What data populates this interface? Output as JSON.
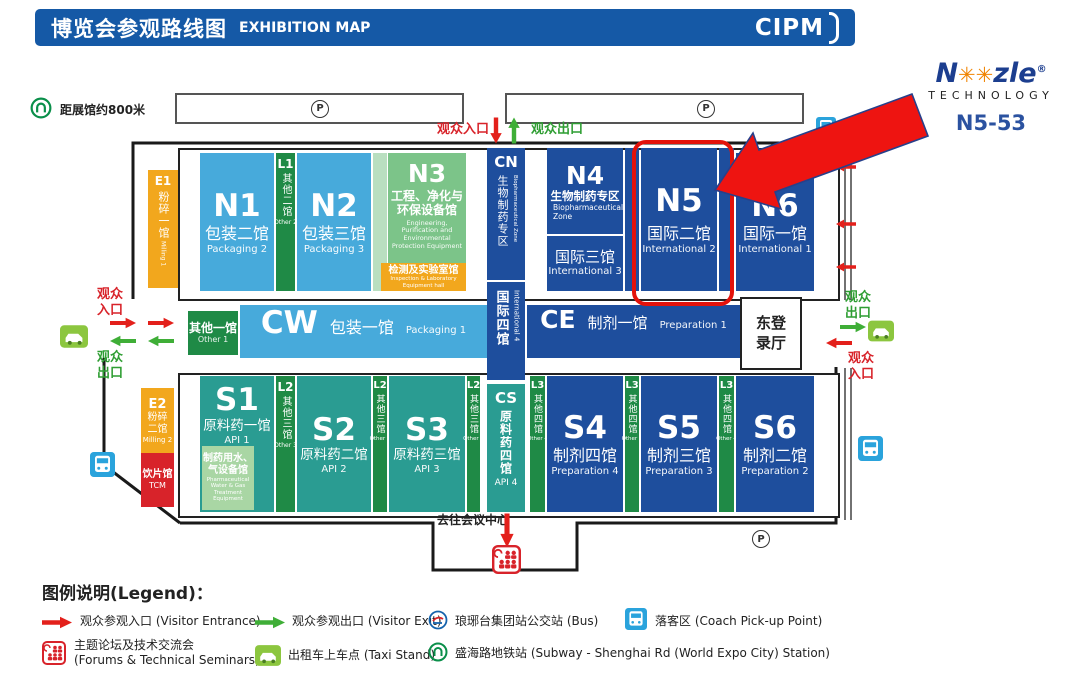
{
  "palette": {
    "header_blue": "#1559a6",
    "dark_blue": "#1e4e9d",
    "light_blue": "#47aadb",
    "teal": "#2a9c92",
    "dark_green": "#1f8a46",
    "hall_green": "#7cc489",
    "orange": "#f2a71d",
    "tcm_red": "#d8232a",
    "arrow_red": "#e3201b",
    "arrow_green": "#3fae37",
    "highlight_red": "#e3120b"
  },
  "header": {
    "title_cn": "博览会参观路线图",
    "title_en": "EXHIBITION MAP",
    "logo_text": "CIPM"
  },
  "branding": {
    "wordmark_n": "N",
    "wordmark_o": "✳",
    "wordmark_rest": "zle",
    "registered": "®",
    "subtitle": "TECHNOLOGY",
    "booth_no": "N5-53"
  },
  "map": {
    "subway_note": "距展馆约800米",
    "parking_label": "P",
    "top_entrance": "观众入口",
    "top_exit": "观众出口",
    "side": {
      "visitors": "观众",
      "entrance": "入口",
      "exit": "出口"
    },
    "east_hall_l1": "东登",
    "east_hall_l2": "录厅",
    "to_conference": "去往会议中心"
  },
  "halls": {
    "E1": {
      "code": "E1",
      "cn": "粉碎一馆",
      "en": "Milling 1"
    },
    "N1": {
      "code": "N1",
      "cn": "包装二馆",
      "en": "Packaging 2"
    },
    "L1": {
      "code": "L1",
      "cn": "其他二馆",
      "en": "Other 2"
    },
    "N2": {
      "code": "N2",
      "cn": "包装三馆",
      "en": "Packaging 3"
    },
    "N3": {
      "code": "N3",
      "cn": "工程、净化与环保设备馆",
      "en": "Engineering, Purification and Environmental Protection Equipment",
      "sub_cn": "检测及实验室馆",
      "sub_en": "Inspection & Laboratory Equipment hall"
    },
    "CN": {
      "code": "CN",
      "cn": "生物制药专区",
      "en": "Biopharmaceutical Zone"
    },
    "INTL4": {
      "cn": "国际四馆",
      "en": "International 4"
    },
    "N4": {
      "code": "N4",
      "cn": "生物制药专区",
      "en": "Biopharmaceutical Zone",
      "sub_cn": "国际三馆",
      "sub_en": "International 3"
    },
    "N5": {
      "code": "N5",
      "cn": "国际二馆",
      "en": "International 2"
    },
    "N6": {
      "code": "N6",
      "cn": "国际一馆",
      "en": "International 1"
    },
    "OTHER1": {
      "cn": "其他一馆",
      "en": "Other 1"
    },
    "CW": {
      "code": "CW",
      "cn": "包装一馆",
      "en": "Packaging 1"
    },
    "CE": {
      "code": "CE",
      "cn": "制剂一馆",
      "en": "Preparation 1"
    },
    "E2": {
      "code": "E2",
      "cn": "粉碎二馆",
      "en": "Milling 2"
    },
    "TCM": {
      "cn": "饮片馆",
      "en": "TCM"
    },
    "S1": {
      "code": "S1",
      "cn": "原料药一馆",
      "en": "API 1",
      "sub_cn": "制药用水、气设备馆",
      "sub_en": "Pharmaceutical Water & Gas Treatment Equipment"
    },
    "L2": {
      "code": "L2",
      "cn": "其他三馆",
      "en": "Other 3"
    },
    "S2": {
      "code": "S2",
      "cn": "原料药二馆",
      "en": "API 2"
    },
    "S3": {
      "code": "S3",
      "cn": "原料药三馆",
      "en": "API 3"
    },
    "CS": {
      "code": "CS",
      "cn": "原料药四馆",
      "en": "API 4"
    },
    "L3": {
      "code": "L3",
      "cn": "其他四馆",
      "en": "Other 4"
    },
    "S4": {
      "code": "S4",
      "cn": "制剂四馆",
      "en": "Preparation 4"
    },
    "S5": {
      "code": "S5",
      "cn": "制剂三馆",
      "en": "Preparation 3"
    },
    "S6": {
      "code": "S6",
      "cn": "制剂二馆",
      "en": "Preparation 2"
    }
  },
  "legend": {
    "title": "图例说明(Legend)：",
    "visitor_entrance": "观众参观入口 (Visitor Entrance)",
    "visitor_exit": "观众参观出口 (Visitor Exit)",
    "bus": "琅琊台集团站公交站 (Bus)",
    "coach": "落客区 (Coach Pick-up Point)",
    "forums_l1": "主题论坛及技术交流会",
    "forums_l2": "(Forums & Technical Seminars)",
    "taxi": "出租车上车点 (Taxi Stand)",
    "subway": "盛海路地铁站 (Subway - Shenghai Rd (World Expo City) Station)"
  }
}
